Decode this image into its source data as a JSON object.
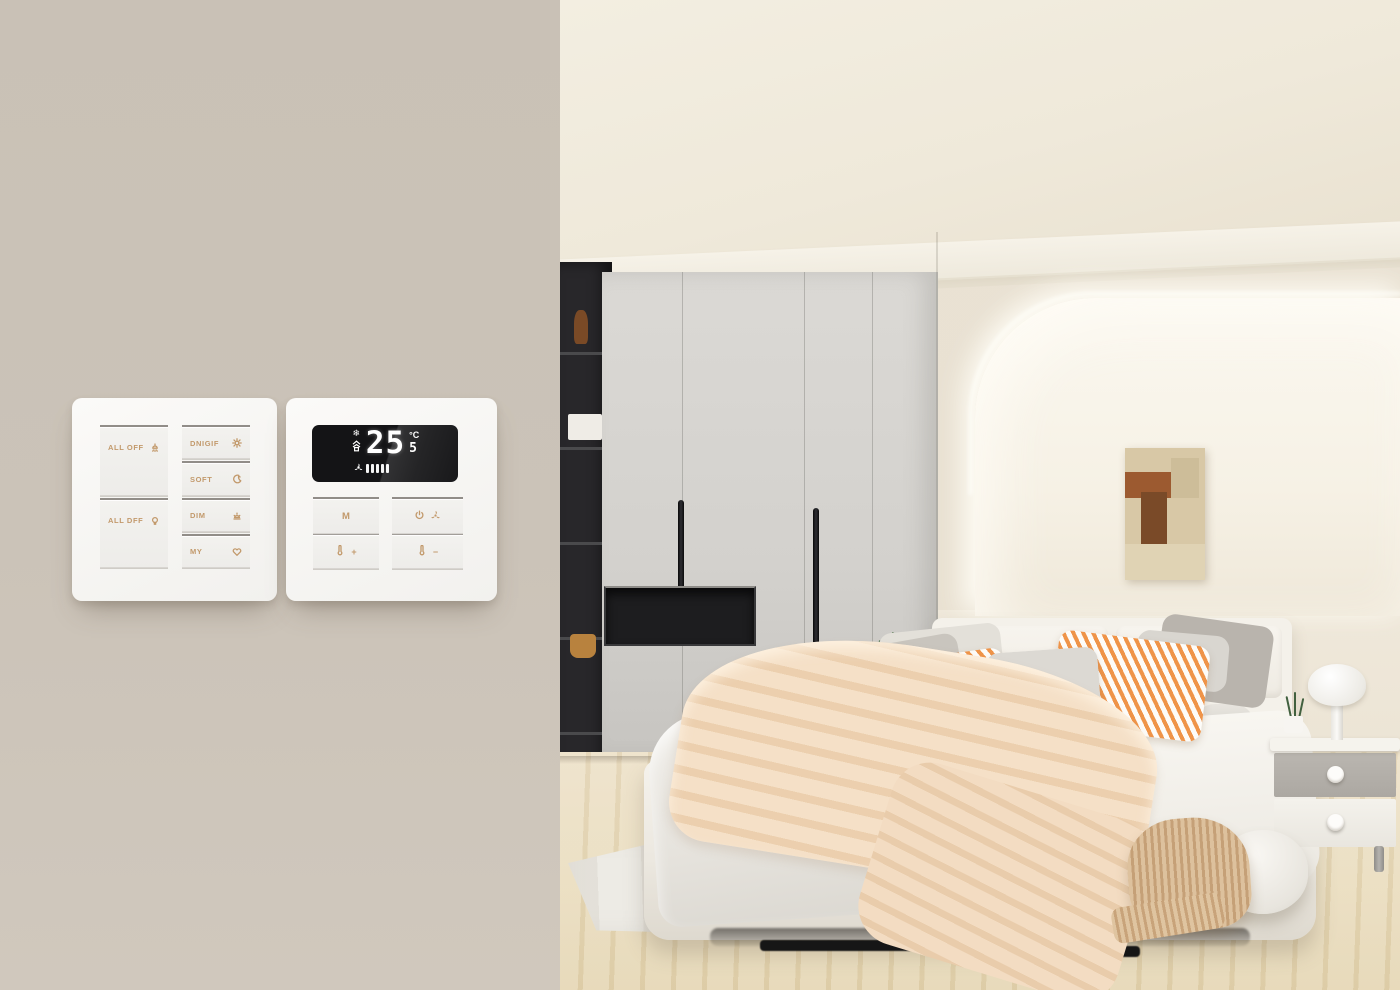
{
  "colors": {
    "wall_taupe": "#cac2b8",
    "accent_gold": "#c2996b",
    "stripe_orange": "#ef9449",
    "display_bg": "#0c0c0e",
    "wardrobe_gray": "#d6d4d0"
  },
  "switch_panel": {
    "buttons": [
      {
        "label": "ALL OFF",
        "icon": "pendant-light-icon"
      },
      {
        "label": "ALL DFF",
        "icon": "bulb-icon"
      },
      {
        "label": "DNIGIF",
        "icon": "sun-icon"
      },
      {
        "label": "SOFT",
        "icon": "moon-icon"
      },
      {
        "label": "DIM",
        "icon": "dimmer-icon"
      },
      {
        "label": "MY",
        "icon": "heart-icon"
      }
    ]
  },
  "thermostat_panel": {
    "display": {
      "snowflake_glyph": "❄",
      "mode_icons": [
        "snowflake-icon",
        "home-swing-icon"
      ],
      "temperature": "25",
      "unit": "°C",
      "decimal_digit": "5",
      "fan_icon": "fan-icon",
      "fan_speed_bars": 5
    },
    "buttons": [
      {
        "label": "M",
        "icon": ""
      },
      {
        "label": "",
        "icon": "power-fan-icon"
      },
      {
        "label": "",
        "icon": "temp-up-icon",
        "sign": "+"
      },
      {
        "label": "",
        "icon": "temp-down-icon",
        "sign": "−"
      }
    ]
  }
}
